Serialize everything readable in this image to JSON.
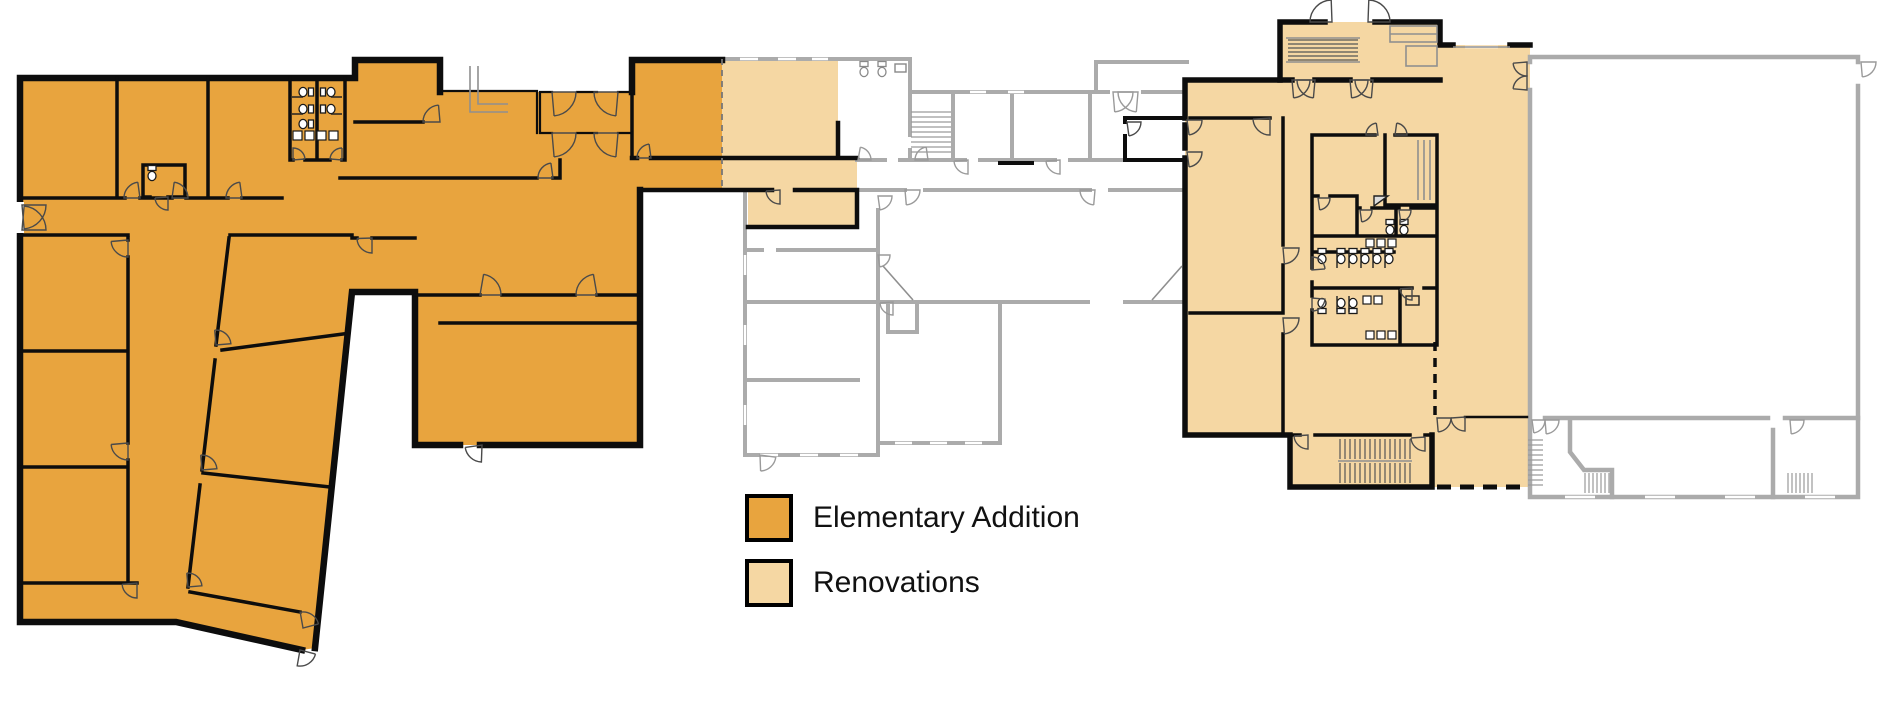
{
  "page": {
    "background": "#ffffff"
  },
  "legend": {
    "items": [
      {
        "id": "elementary-addition",
        "label": "Elementary Addition",
        "color": "#E8A43E"
      },
      {
        "id": "renovations",
        "label": "Renovations",
        "color": "#F5D7A3"
      }
    ]
  },
  "plan": {
    "colors": {
      "addition_fill": "#E8A43E",
      "renovation_fill": "#F5D7A3",
      "new_wall": "#0d0d0d",
      "existing_wall": "#ABABAB",
      "thin_detail": "#8f8f8f",
      "fixture_line": "#3a3a3a",
      "door_swing": "#4a4a4a",
      "existing_door_swing": "#9a9a9a"
    }
  }
}
